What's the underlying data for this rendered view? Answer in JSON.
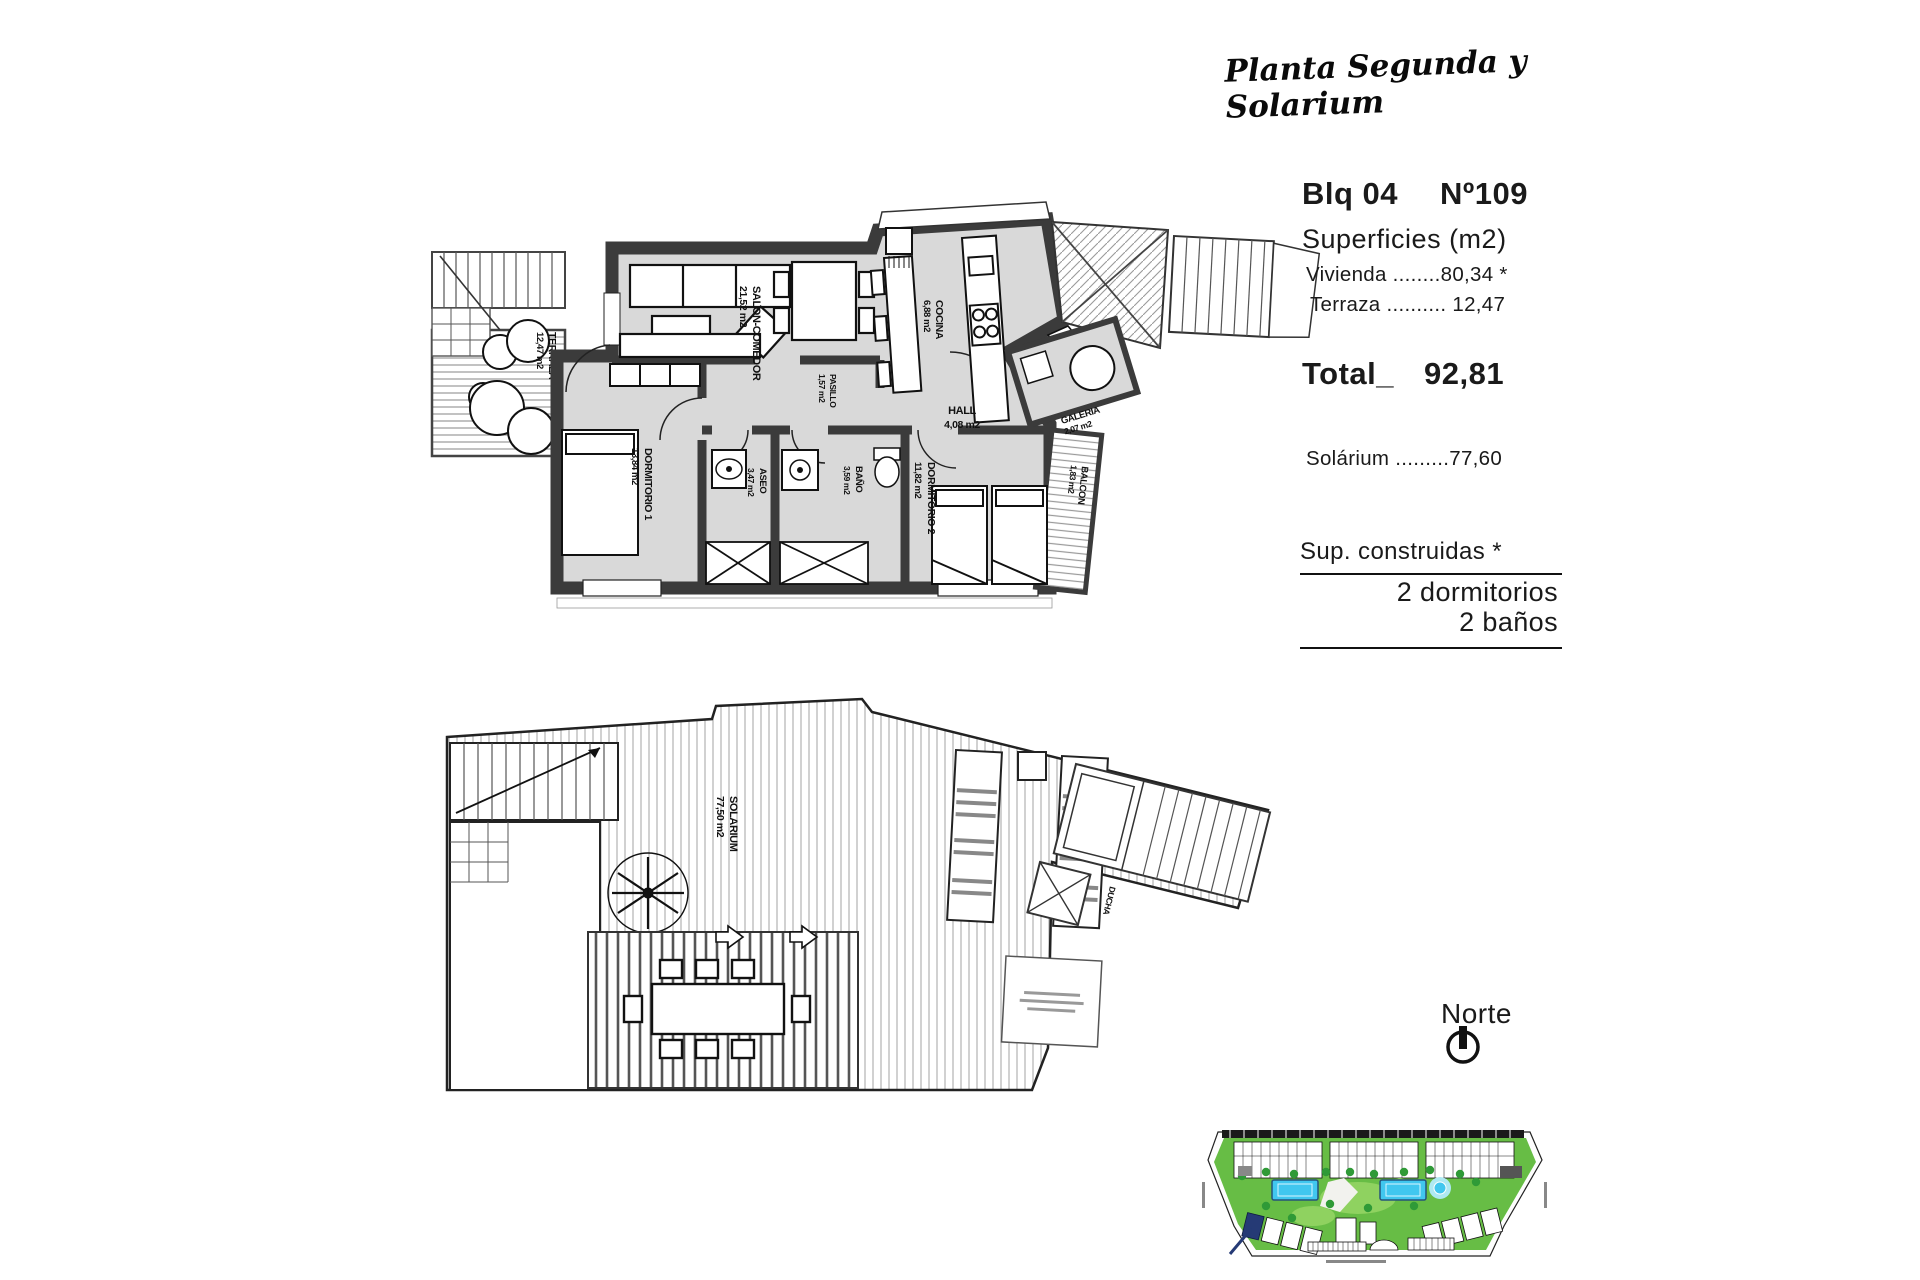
{
  "title": "Planta Segunda y Solarium",
  "info": {
    "block": "Blq 04",
    "unit": "Nº109",
    "surfaces_heading": "Superficies (m2)",
    "vivienda_line": "Vivienda ........80,34 *",
    "terraza_line": "Terraza .......... 12,47",
    "total_label": "Total_",
    "total_value": "92,81",
    "solarium_line": "Solárium .........77,60",
    "sup_heading": "Sup. construidas *",
    "bedrooms_line": "2 dormitorios",
    "baths_line": "2 baños"
  },
  "north": {
    "label": "Norte"
  },
  "plan_upper": {
    "terraza": {
      "name": "TERRAZA",
      "area": "12,47 m2"
    },
    "salon": {
      "name": "SALON-COMEDOR",
      "area": "21,52 m2"
    },
    "cocina": {
      "name": "COCINA",
      "area": "6,88 m2"
    },
    "hall": {
      "name": "HALL",
      "area": "4,08 m2"
    },
    "galeria": {
      "name": "GALERIA",
      "area": "2,07 m2"
    },
    "pasillo": {
      "name": "PASILLO",
      "area": "1,57 m2"
    },
    "dormitorio1": {
      "name": "DORMITORIO 1",
      "area": "13,84 m2"
    },
    "aseo": {
      "name": "ASEO",
      "area": "3,47 m2"
    },
    "bano": {
      "name": "BAÑO",
      "area": "3,59 m2"
    },
    "dormitorio2": {
      "name": "DORMITORIO 2",
      "area": "11,82 m2"
    },
    "balcon": {
      "name": "BALCON",
      "area": "1,83 m2"
    }
  },
  "plan_lower": {
    "solarium": {
      "name": "SOLARIUM",
      "area": "77,50 m2"
    },
    "ducha": {
      "name": "DUCHA"
    }
  },
  "colors": {
    "floor": "#d9d9d9",
    "wall": "#3b3b3b",
    "site_green": "#67bd45",
    "site_green_light": "#8fd260",
    "pool_blue": "#41c7ef",
    "highlight_navy": "#253a75"
  }
}
